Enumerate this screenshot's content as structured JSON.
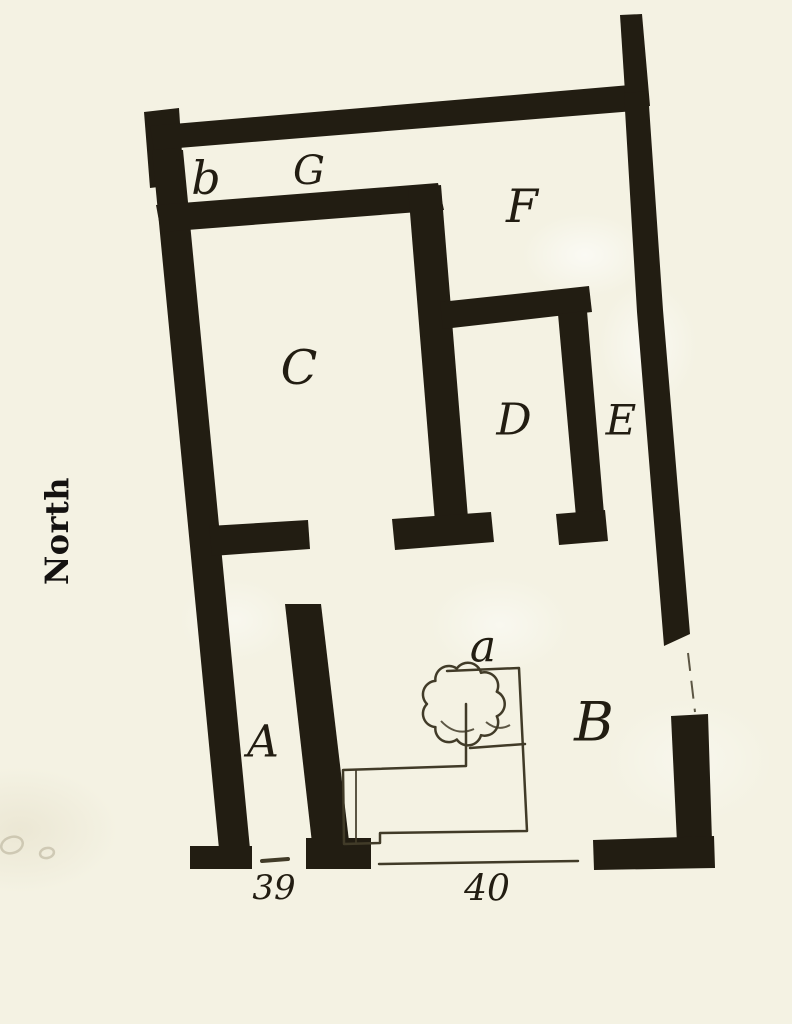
{
  "colors": {
    "paper": "#f4f2e3",
    "ink": "#221d12",
    "thin": "#413b28",
    "faint": "#b5ad96"
  },
  "plan": {
    "compass": {
      "label": "North"
    },
    "rooms": [
      {
        "key": "b",
        "label": "b"
      },
      {
        "key": "G",
        "label": "G"
      },
      {
        "key": "F",
        "label": "F"
      },
      {
        "key": "C",
        "label": "C"
      },
      {
        "key": "D",
        "label": "D"
      },
      {
        "key": "E",
        "label": "E"
      },
      {
        "key": "A",
        "label": "A"
      },
      {
        "key": "B",
        "label": "B"
      },
      {
        "key": "a",
        "label": "a"
      }
    ],
    "entrances": [
      {
        "number": "39"
      },
      {
        "number": "40"
      }
    ]
  }
}
